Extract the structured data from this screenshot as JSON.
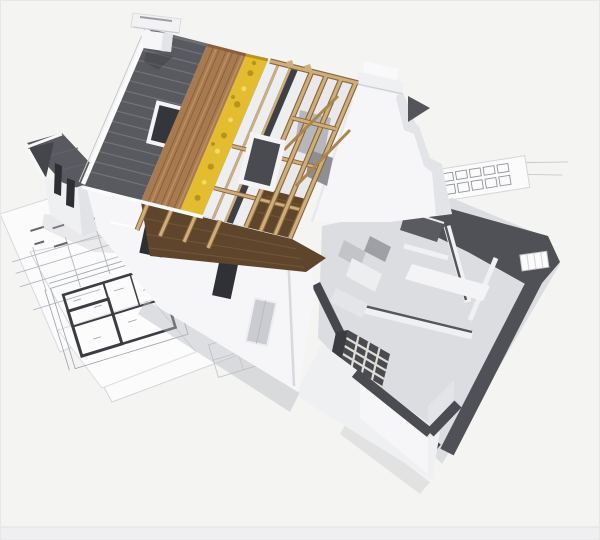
{
  "image": {
    "type": "3d-architectural-render",
    "subject": "Cutaway model house under construction showing roof layers, rafters, insulation and ground-floor rooms, standing on architectural blueprints",
    "width": 600,
    "height": 540
  },
  "elements": [
    "blueprint-sheets",
    "floor-plan-drawing",
    "roof-tiles",
    "roof-sheathing-wood",
    "insulation-layer",
    "membrane-panels",
    "open-rafters",
    "skylight-windows",
    "chimney",
    "dutch-gable-wall",
    "front-facade",
    "dormer-wing",
    "attic-floor",
    "interior-cutaway",
    "grid-wall-unit",
    "kitchen-units",
    "corner-walls"
  ],
  "colors": {
    "background": "#f4f4f3",
    "frame": "#e7e7e6",
    "bottomStrip": "#efeff1",
    "bottomLine": "#e2e2e4",
    "paper": "#fbfbfc",
    "paperEdge": "#d8d9dc",
    "paperLine": "#b4b8c1",
    "planLine": "#3c3d42",
    "planThin": "#9aa0a8",
    "shadow": "#b9bbc0",
    "tile": "#595a5f",
    "tileLine": "#73747a",
    "tileRidge": "#6d6e73",
    "verge": "#fbfbfc",
    "wood": "#a87a50",
    "woodDark": "#8a5f3b",
    "woodLight": "#c09467",
    "insulation": "#e3bc2f",
    "insulationDark": "#b8941f",
    "insulationLight": "#f2d968",
    "panel": "#edeef0",
    "panelGap": "#3f4045",
    "timber": "#cfae7d",
    "timberDark": "#8a663a",
    "atticFloor": "#5e452b",
    "atticFloorLine": "#73573a",
    "interiorBg": "#e9e9ec",
    "interiorGrey": "#b6b7bc",
    "interiorGrey2": "#8e8f94",
    "wallWhite": "#f6f6f8",
    "wallShade": "#e3e4e7",
    "wallDark": "#d9dadd",
    "windowDark": "#2e2f34",
    "cutTop": "#505156",
    "floor": "#dcdde0",
    "brickBg": "#4a4b50",
    "brickLine": "#e0ddd6",
    "cabinet1": "#c3c4c8",
    "cabinet2": "#eceef0",
    "cabinet3": "#9fa0a5",
    "underEaves": "#3f4045",
    "glass": "#35363b"
  }
}
